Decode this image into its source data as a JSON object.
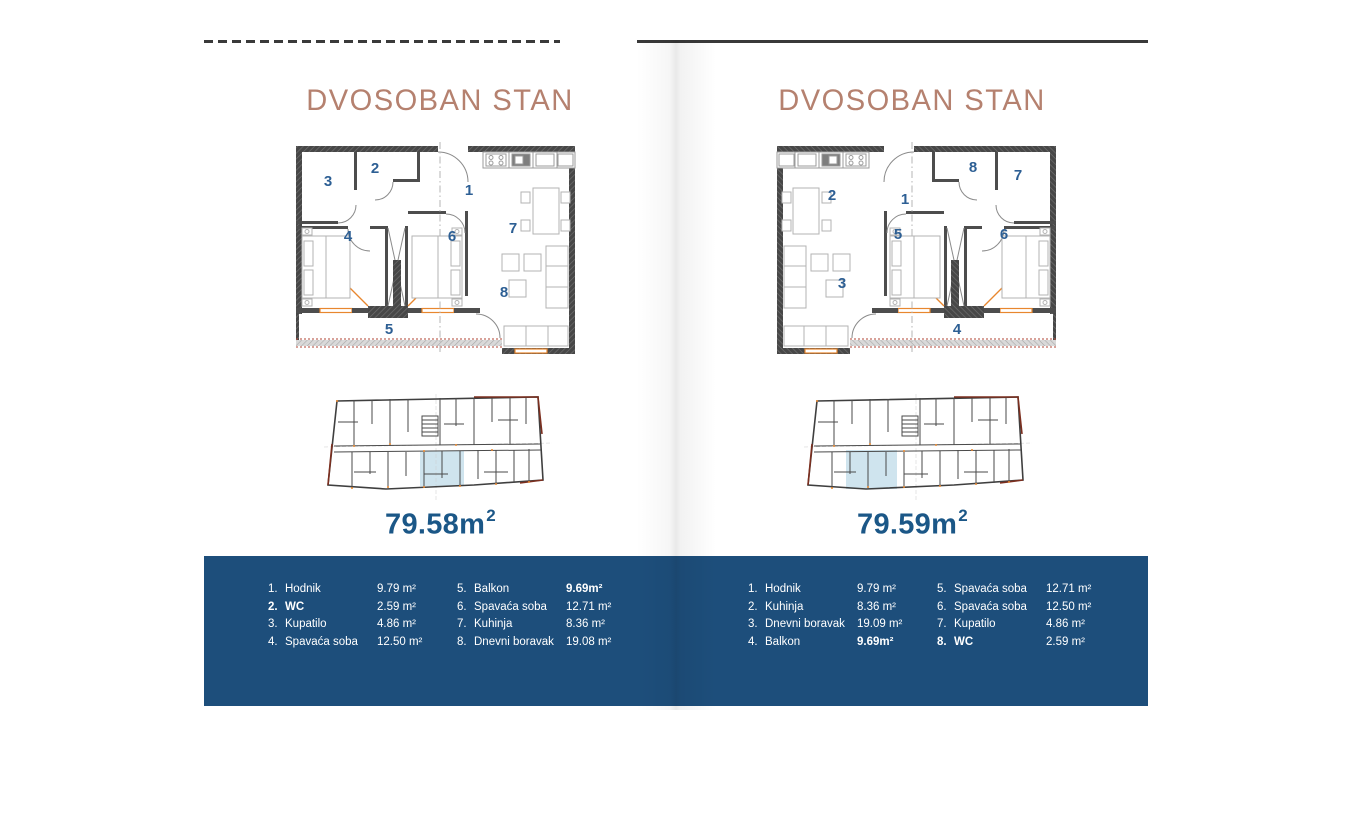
{
  "colors": {
    "title": "#b5816f",
    "area_text": "#1b5787",
    "band_bg": "#1d4e7b",
    "plan_number": "#2d5f94",
    "site_highlight": "#cfe4ee",
    "accent_orange": "#e8872e",
    "accent_red": "#7c2f1f"
  },
  "pages": [
    {
      "title": "DVOSOBAN STAN",
      "area": {
        "value": "79.58",
        "unit": "m",
        "sup": "2"
      },
      "plan_numbers": [
        {
          "n": "1",
          "x": 179,
          "y": 53
        },
        {
          "n": "2",
          "x": 85,
          "y": 31
        },
        {
          "n": "3",
          "x": 38,
          "y": 44
        },
        {
          "n": "4",
          "x": 58,
          "y": 99
        },
        {
          "n": "5",
          "x": 99,
          "y": 192
        },
        {
          "n": "6",
          "x": 162,
          "y": 99
        },
        {
          "n": "7",
          "x": 223,
          "y": 91
        },
        {
          "n": "8",
          "x": 214,
          "y": 155
        }
      ],
      "site_highlight": {
        "x": 96,
        "y": 57,
        "w": 44,
        "h": 35
      },
      "legend_columns": [
        [
          {
            "num": "1.",
            "name": "Hodnik",
            "value": "9.79 m²"
          },
          {
            "num": "2.",
            "name": "WC",
            "value": "2.59 m²",
            "name_bold": true
          },
          {
            "num": "3.",
            "name": "Kupatilo",
            "value": "4.86 m²"
          },
          {
            "num": "4.",
            "name": "Spavaća soba",
            "value": "12.50 m²"
          }
        ],
        [
          {
            "num": "5.",
            "name": "Balkon",
            "value": "9.69m²",
            "value_bold": true
          },
          {
            "num": "6.",
            "name": "Spavaća soba",
            "value": "12.71 m²"
          },
          {
            "num": "7.",
            "name": "Kuhinja",
            "value": "8.36 m²"
          },
          {
            "num": "8.",
            "name": "Dnevni boravak",
            "value": "19.08 m²"
          }
        ]
      ]
    },
    {
      "title": "DVOSOBAN STAN",
      "area": {
        "value": "79.59",
        "unit": "m",
        "sup": "2"
      },
      "plan_numbers": [
        {
          "n": "1",
          "x": 143,
          "y": 62
        },
        {
          "n": "2",
          "x": 70,
          "y": 58
        },
        {
          "n": "3",
          "x": 80,
          "y": 146
        },
        {
          "n": "4",
          "x": 195,
          "y": 192
        },
        {
          "n": "5",
          "x": 136,
          "y": 97
        },
        {
          "n": "6",
          "x": 242,
          "y": 97
        },
        {
          "n": "7",
          "x": 256,
          "y": 38
        },
        {
          "n": "8",
          "x": 211,
          "y": 30
        }
      ],
      "site_highlight": {
        "x": 42,
        "y": 56,
        "w": 51,
        "h": 39
      },
      "legend_columns": [
        [
          {
            "num": "1.",
            "name": "Hodnik",
            "value": "9.79 m²"
          },
          {
            "num": "2.",
            "name": "Kuhinja",
            "value": "8.36 m²"
          },
          {
            "num": "3.",
            "name": "Dnevni boravak",
            "value": "19.09 m²"
          },
          {
            "num": "4.",
            "name": "Balkon",
            "value": "9.69m²",
            "value_bold": true
          }
        ],
        [
          {
            "num": "5.",
            "name": "Spavaća soba",
            "value": "12.71 m²"
          },
          {
            "num": "6.",
            "name": "Spavaća soba",
            "value": "12.50 m²"
          },
          {
            "num": "7.",
            "name": "Kupatilo",
            "value": "4.86 m²"
          },
          {
            "num": "8.",
            "name": "WC",
            "value": "2.59 m²",
            "name_bold": true
          }
        ]
      ]
    }
  ]
}
